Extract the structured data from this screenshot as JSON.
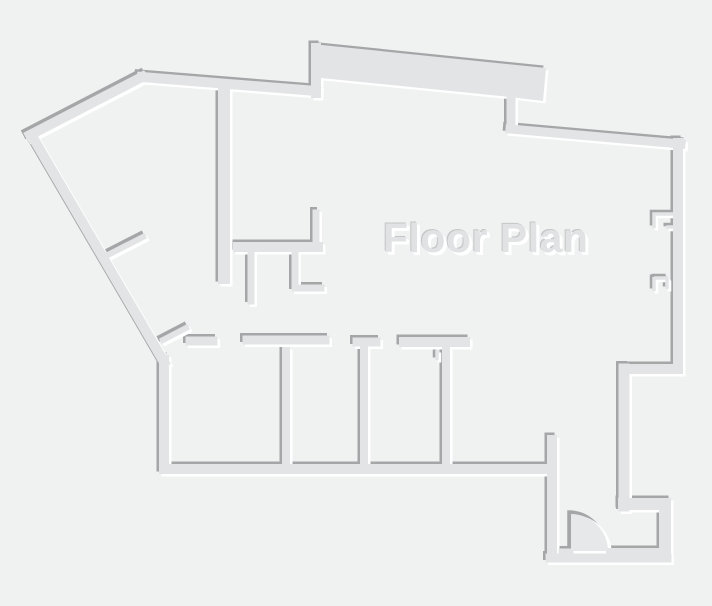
{
  "title": {
    "text": "Floor Plan"
  },
  "canvas": {
    "width": 712,
    "height": 606,
    "background": "#f0f1f1"
  },
  "palette": {
    "wall_fill": "#e3e4e5",
    "wall_shadow": "#a4a6a7",
    "wall_highlight": "#ffffff",
    "door_fill": "#e7e8e9",
    "text_fill": "#e0e2e3",
    "text_shadow_dark": "#c3c5c6",
    "text_shadow_light": "#ffffff"
  },
  "floor_plan": {
    "emboss": {
      "shadow_offset": -2.5,
      "highlight_offset": 2.5
    },
    "walls": [
      [
        30,
        135,
        142,
        77,
        10
      ],
      [
        142,
        77,
        316,
        91,
        10
      ],
      [
        316,
        93,
        316,
        48,
        10
      ],
      [
        511,
        100,
        511,
        126,
        9
      ],
      [
        510,
        129,
        681,
        144,
        9
      ],
      [
        678,
        143,
        678,
        366,
        10
      ],
      [
        678,
        369,
        624,
        369,
        10
      ],
      [
        624,
        369,
        624,
        506,
        11
      ],
      [
        624,
        504,
        665,
        504,
        12
      ],
      [
        665,
        504,
        665,
        555,
        12
      ],
      [
        610,
        552,
        667,
        552,
        8
      ],
      [
        550,
        558,
        667,
        558,
        9
      ],
      [
        552,
        440,
        552,
        557,
        10
      ],
      [
        165,
        469,
        551,
        469,
        10
      ],
      [
        164,
        360,
        164,
        469,
        10
      ],
      [
        32,
        136,
        164,
        362,
        10
      ],
      [
        224,
        92,
        224,
        278,
        12
      ],
      [
        238,
        247,
        318,
        247,
        10
      ],
      [
        316,
        213,
        316,
        246,
        7
      ],
      [
        251,
        253,
        251,
        301,
        7
      ],
      [
        295,
        253,
        295,
        287,
        7
      ],
      [
        295,
        288,
        321,
        288,
        7
      ],
      [
        190,
        341,
        213,
        341,
        9
      ],
      [
        247,
        340,
        325,
        340,
        9
      ],
      [
        357,
        342,
        376,
        342,
        9
      ],
      [
        364,
        349,
        364,
        463,
        8
      ],
      [
        404,
        342,
        465,
        342,
        10
      ],
      [
        446,
        350,
        446,
        463,
        8
      ],
      [
        286,
        351,
        286,
        463,
        8
      ],
      [
        102,
        258,
        143,
        237,
        6
      ],
      [
        163,
        340,
        186,
        328,
        6
      ],
      [
        561,
        551,
        571,
        551,
        5
      ]
    ],
    "window_marks": [
      [
        [
          654,
          228
        ],
        [
          654,
          214
        ],
        [
          678,
          214
        ]
      ],
      [
        [
          666,
          227
        ],
        [
          678,
          227
        ]
      ],
      [
        [
          654,
          277
        ],
        [
          654,
          291
        ]
      ],
      [
        [
          654,
          278
        ],
        [
          668,
          278
        ]
      ],
      [
        [
          667,
          278
        ],
        [
          667,
          289
        ]
      ],
      [
        [
          437,
          350
        ],
        [
          437,
          360
        ]
      ]
    ],
    "polygons": [
      {
        "name": "balcony-block",
        "points": [
          [
            312,
            44
          ],
          [
            546,
            68
          ],
          [
            543,
            101
          ],
          [
            510,
            97
          ],
          [
            321,
            78
          ]
        ]
      }
    ],
    "door": {
      "name": "door-swing",
      "path": "M 571 551 L 571 514 A 37 37 0 0 1 608 551 Z"
    }
  }
}
